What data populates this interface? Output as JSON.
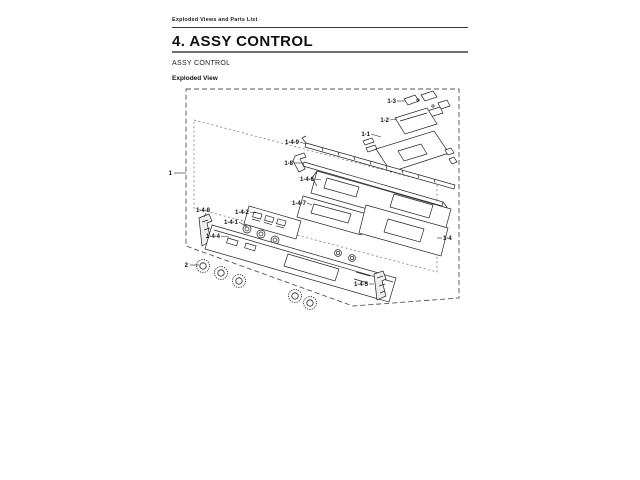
{
  "page": {
    "running_header": "Exploded Views and Parts List",
    "section_title": "4. ASSY CONTROL",
    "subsection_title": "ASSY CONTROL",
    "figure_label": "Exploded View"
  },
  "diagram": {
    "callouts": [
      {
        "label": "1"
      },
      {
        "label": "2"
      },
      {
        "label": "1-3"
      },
      {
        "label": "1-2"
      },
      {
        "label": "1-1"
      },
      {
        "label": "1-4-9"
      },
      {
        "label": "1-8"
      },
      {
        "label": "1-4-6"
      },
      {
        "label": "1-4-7"
      },
      {
        "label": "1-4-2"
      },
      {
        "label": "1-4-1"
      },
      {
        "label": "1-4-8"
      },
      {
        "label": "1-4-4"
      },
      {
        "label": "1-4-5"
      },
      {
        "label": "1-4"
      }
    ]
  },
  "colors": {
    "ink": "#1c1c1c",
    "paper": "#ffffff"
  }
}
